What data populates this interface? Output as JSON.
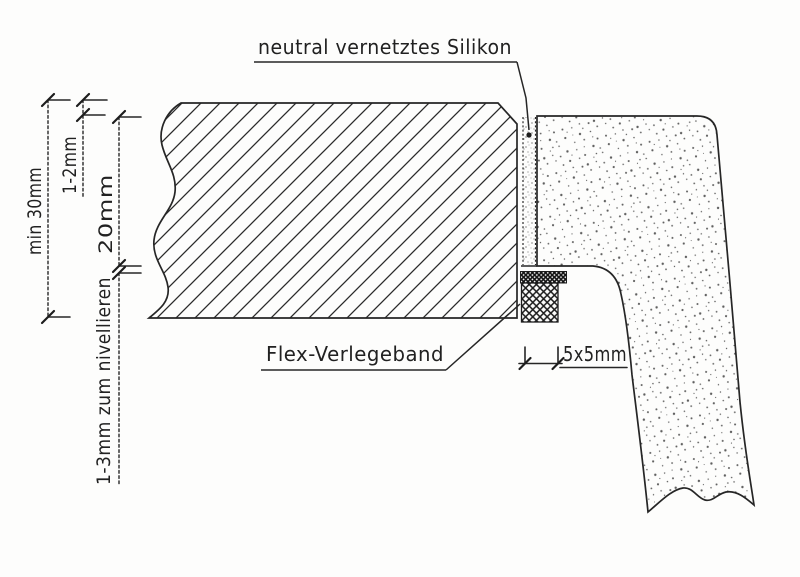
{
  "drawing": {
    "callouts": {
      "silicone": "neutral vernetztes Silikon",
      "flex_tape": "Flex-Verlegeband"
    },
    "dimensions": {
      "countertop_thickness": "min 30mm",
      "joint_top_gap": "1-2mm",
      "rim_height": "20mm",
      "leveling_gap": "1-3mm zum nivellieren",
      "tape_size": "5x5mm"
    },
    "colors": {
      "ink": "#262626",
      "paper": "#fdfdfc"
    }
  }
}
